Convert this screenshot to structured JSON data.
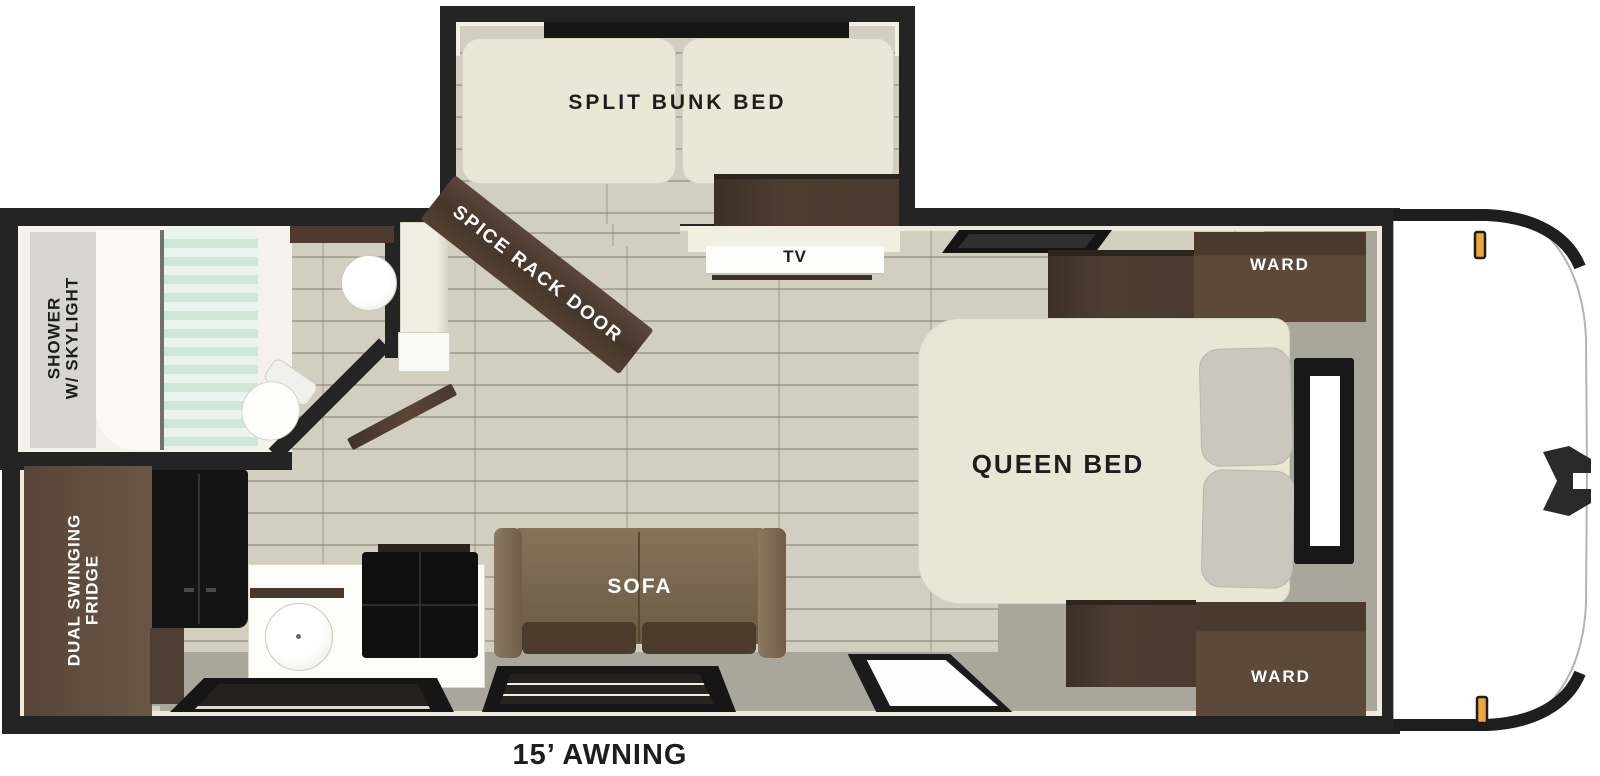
{
  "labels": {
    "bunk": "SPLIT BUNK BED",
    "spice_rack": "SPICE RACK DOOR",
    "tv": "TV",
    "shower_line1": "SHOWER",
    "shower_line2": "W/ SKYLIGHT",
    "ward_top": "WARD",
    "ward_bottom": "WARD",
    "queen_bed": "QUEEN BED",
    "sofa": "SOFA",
    "fridge_line1": "DUAL SWINGING",
    "fridge_line2": "FRIDGE",
    "awning": "15’ AWNING"
  },
  "floorplan": {
    "areas": [
      {
        "name": "bunk-slideout",
        "furniture": [
          "split bunk bed",
          "dresser",
          "window"
        ]
      },
      {
        "name": "bathroom",
        "furniture": [
          "shower with skylight",
          "shower curtain",
          "toilet",
          "vanity sink"
        ]
      },
      {
        "name": "kitchen",
        "furniture": [
          "dual swinging fridge",
          "counter",
          "round sink",
          "cooktop",
          "spice rack door",
          "window"
        ]
      },
      {
        "name": "living",
        "furniture": [
          "sofa",
          "tv shelf",
          "entry door",
          "window"
        ]
      },
      {
        "name": "bedroom",
        "furniture": [
          "queen bed",
          "wardrobe top",
          "wardrobe bottom",
          "overhead cabinet",
          "under-bed cabinet",
          "side window",
          "front window"
        ]
      },
      {
        "name": "exterior",
        "furniture": [
          "15 ft awning",
          "hitch",
          "marker lights",
          "rounded front cap"
        ]
      }
    ]
  },
  "colors": {
    "wall": "#242424",
    "wall_lining": "#efebdf",
    "floor_wood": "#d3cfc0",
    "floor_gray": "#a9a69c",
    "cabinet_dark_wood": "#4a3a2f",
    "ward_wood": "#5d4939",
    "fridge_wood": "#5e4a3c",
    "fridge_doors": "#141414",
    "sofa_brown": "#79674e",
    "sofa_cushion": "#4b3b2a",
    "mattress_cream": "#ebe7d7",
    "pillow_gray": "#cdc6bf",
    "shower_curtain_mint": "#d9ecdf",
    "marker_light_orange": "#f0a43c",
    "label_dark": "#1d1d1d",
    "label_light": "#ffffff"
  }
}
